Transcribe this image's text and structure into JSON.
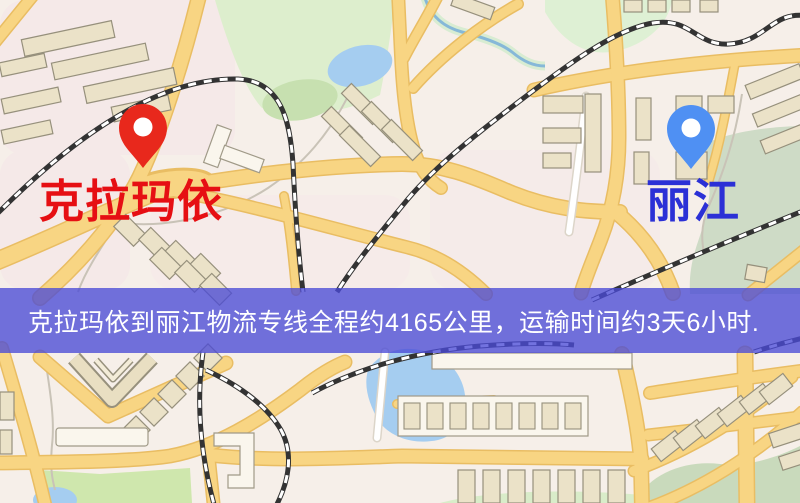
{
  "map": {
    "origin_marker": {
      "label": "克拉玛依",
      "pin_color": "#e8281c",
      "label_color": "#e60f13"
    },
    "destination_marker": {
      "label": "丽江",
      "pin_color": "#4f90f3",
      "label_color": "#2b30d6"
    }
  },
  "banner": {
    "text": "克拉玛依到丽江物流专线全程约4165公里，运输时间约3天6小时.",
    "background_color": "#4a4ad6",
    "text_color": "#ffffff",
    "distance_km": "4165",
    "duration": "3天6小时"
  },
  "map_colors": {
    "background": "#f6efe9",
    "road_fill": "#f8d583",
    "road_casing": "#e9bd63",
    "building_fill": "#ebe2c8",
    "water": "#a5cdf0",
    "park_green": "#ddeecd",
    "railway_dark": "#333333"
  }
}
